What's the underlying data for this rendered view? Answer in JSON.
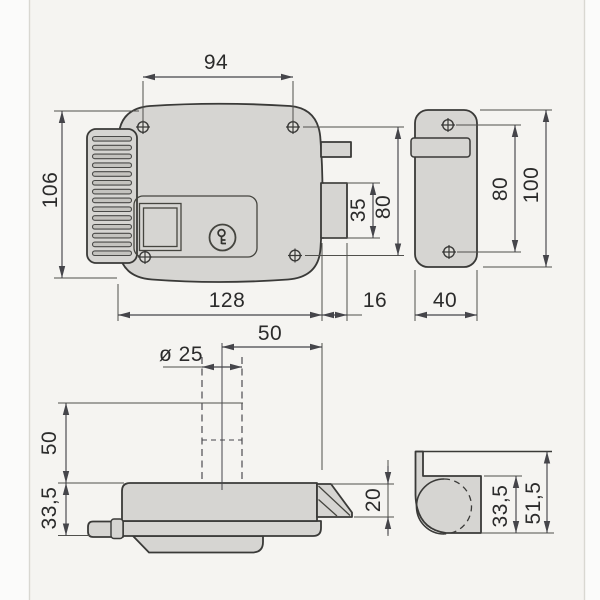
{
  "title": "Electric rim lock technical drawing",
  "colors": {
    "paper": "#f5f4f1",
    "part_fill": "#d6d5d2",
    "outline": "#3a3a38",
    "dimension_line": "#45454a",
    "text": "#2b2b2b"
  },
  "views": {
    "front": {
      "label": "lock-front-view",
      "dims": {
        "screw_span": "94",
        "height": "106",
        "bolt_offset": "35",
        "screw_height": "80",
        "width": "128",
        "bolt_throw": "16"
      }
    },
    "strike_front": {
      "label": "strike-plate-front-view",
      "dims": {
        "screw_spacing": "80",
        "height": "100",
        "width": "40"
      }
    },
    "bottom": {
      "label": "lock-bottom-view",
      "dims": {
        "backset": "50",
        "cylinder": "ø 25",
        "cylinder_length": "50",
        "case_depth": "33,5",
        "latch_depth": "20"
      }
    },
    "strike_bottom": {
      "label": "strike-box-bottom-view",
      "dims": {
        "inner_depth": "33,5",
        "total_depth": "51,5"
      }
    }
  }
}
